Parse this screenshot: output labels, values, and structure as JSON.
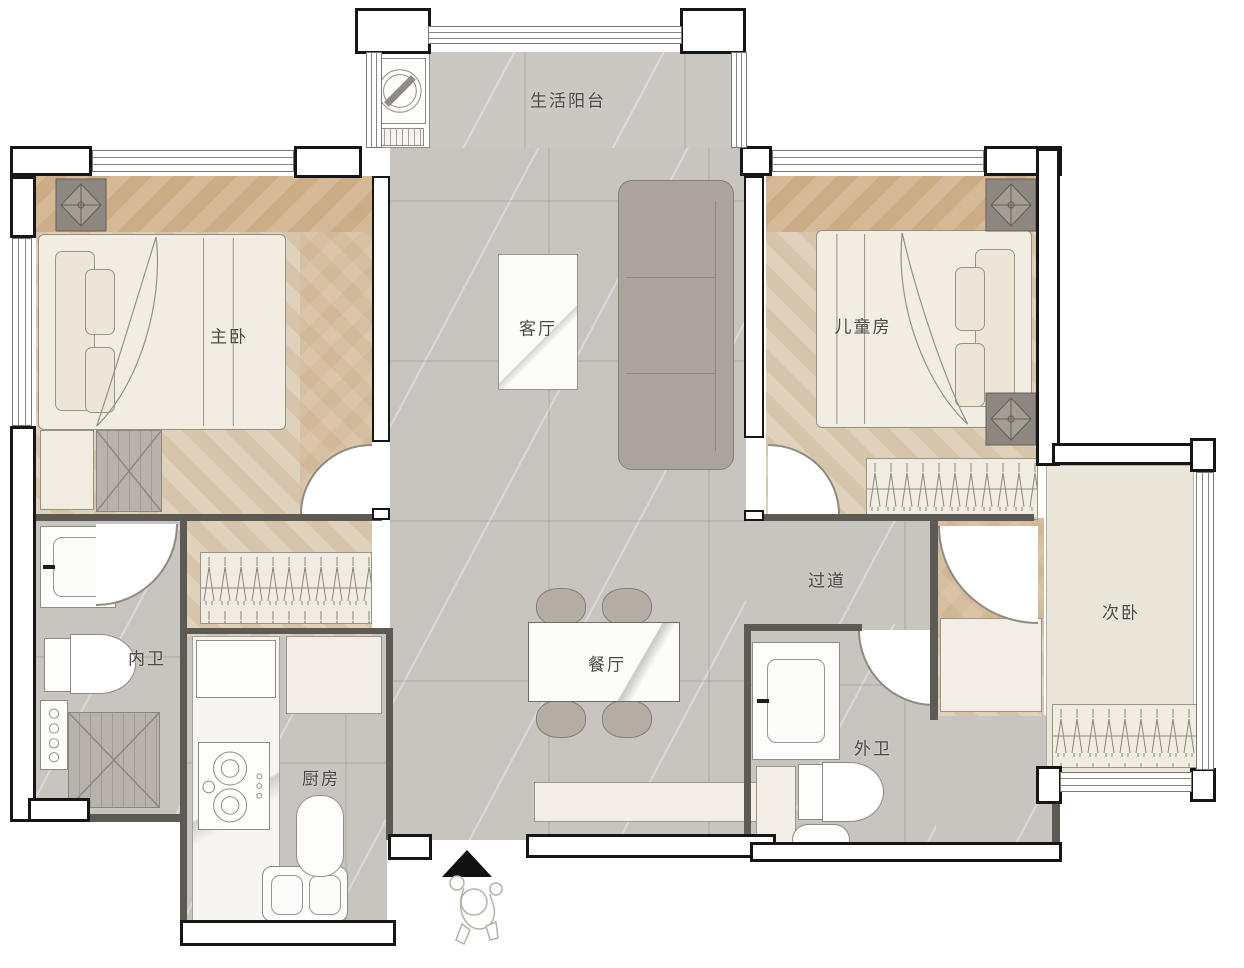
{
  "plan_title": "two-bed apartment floor plan",
  "rooms": {
    "balcony": {
      "label": "生活阳台"
    },
    "master_bedroom": {
      "label": "主卧"
    },
    "living_room": {
      "label": "客厅"
    },
    "kids_room": {
      "label": "儿童房"
    },
    "secondary_bedroom": {
      "label": "次卧"
    },
    "hallway": {
      "label": "过道"
    },
    "inner_bathroom": {
      "label": "内卫"
    },
    "dining_room": {
      "label": "餐厅"
    },
    "outer_bathroom": {
      "label": "外卫"
    },
    "kitchen": {
      "label": "厨房"
    }
  },
  "icons": {
    "entrance_arrow": "▲",
    "washing_machine": "drum-circle-with-diagonal",
    "person_figure": "walking-person-outline",
    "clothes_hanger": "hanger-rows-in-wardrobe",
    "column_diamond": "diamond-with-cross",
    "cabinet_x": "x-cross-storage-box"
  },
  "colors": {
    "wall": "#161616",
    "tile_floor": "#c8c5c0",
    "wood_floor_light": "#e0d1bd",
    "wood_floor_dark": "#cba981",
    "beige_floor": "#eae6da",
    "furniture_cream": "#f1ece2",
    "sofa": "#aaa49c",
    "label_text": "#4a4843"
  }
}
